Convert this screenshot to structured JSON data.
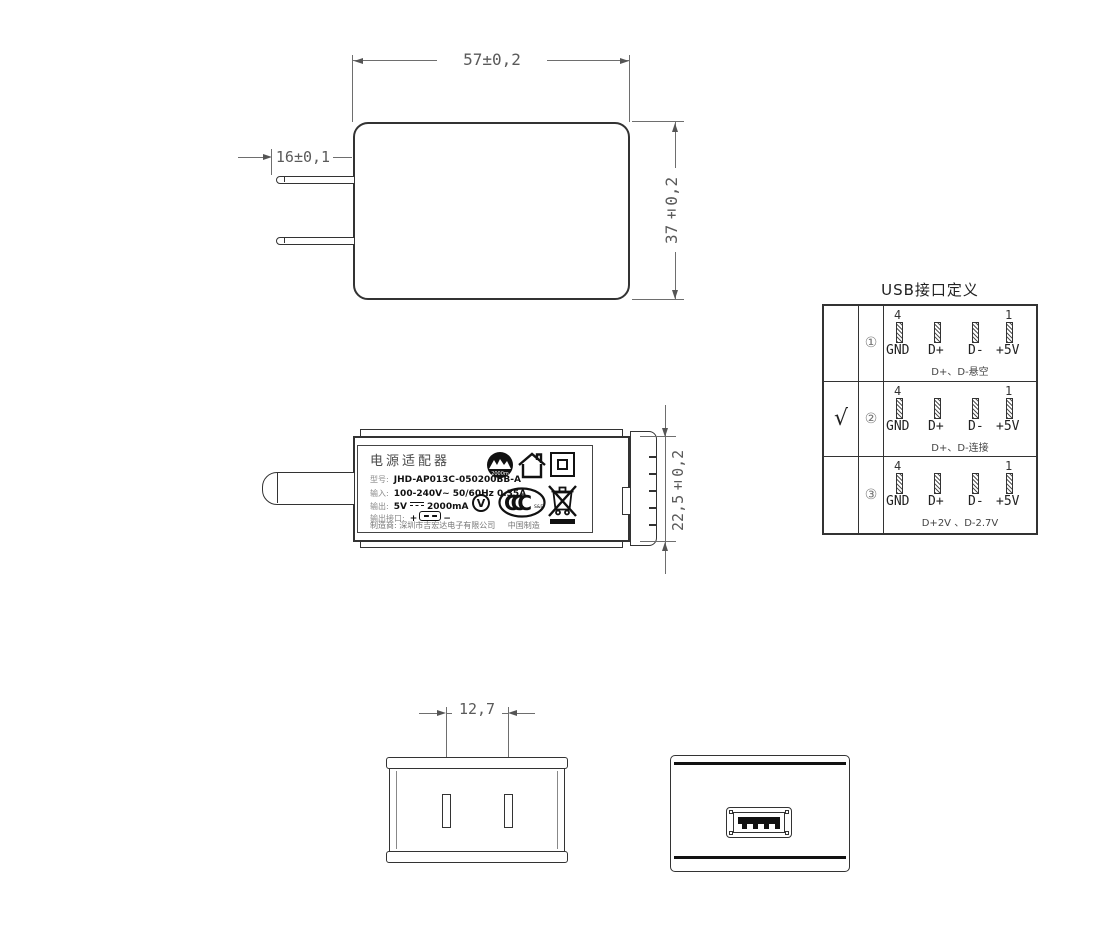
{
  "top_view": {
    "width_dim": "57±0,2",
    "prong_dim": "16±0,1",
    "height_dim": "37±0,2"
  },
  "side_view": {
    "height_dim": "22,5±0,2"
  },
  "front_view": {
    "pin_spacing_dim": "12,7"
  },
  "label": {
    "title": "电源适配器",
    "model_label": "型号:",
    "model_value": "JHD-AP013C-050200BB-A",
    "input_label": "输入:",
    "input_value": "100-240V~  50/60Hz  0.35A",
    "output_label": "输出:",
    "output_voltage": "5V",
    "output_current": "2000mA",
    "port_label": "输出接口:",
    "port_plus": "+",
    "port_minus": "−",
    "mfr_label": "制造商:",
    "mfr_value": "深圳市吉宏达电子有限公司",
    "made_in": "中国制造",
    "altitude_text": "2000m",
    "ccc_text": "CCC",
    "ccc_sub": "S&E",
    "efficiency_text": "V"
  },
  "usb_table": {
    "title": "USB接口定义",
    "pin_num_left": "4",
    "pin_num_right": "1",
    "pin_labels": [
      "GND",
      "D+",
      "D-",
      "+5V"
    ],
    "rows": [
      {
        "check": "",
        "num": "①",
        "note": "D+、D-悬空"
      },
      {
        "check": "√",
        "num": "②",
        "note": "D+、D-连接"
      },
      {
        "check": "",
        "num": "③",
        "note": "D+2V 、D-2.7V"
      }
    ]
  }
}
